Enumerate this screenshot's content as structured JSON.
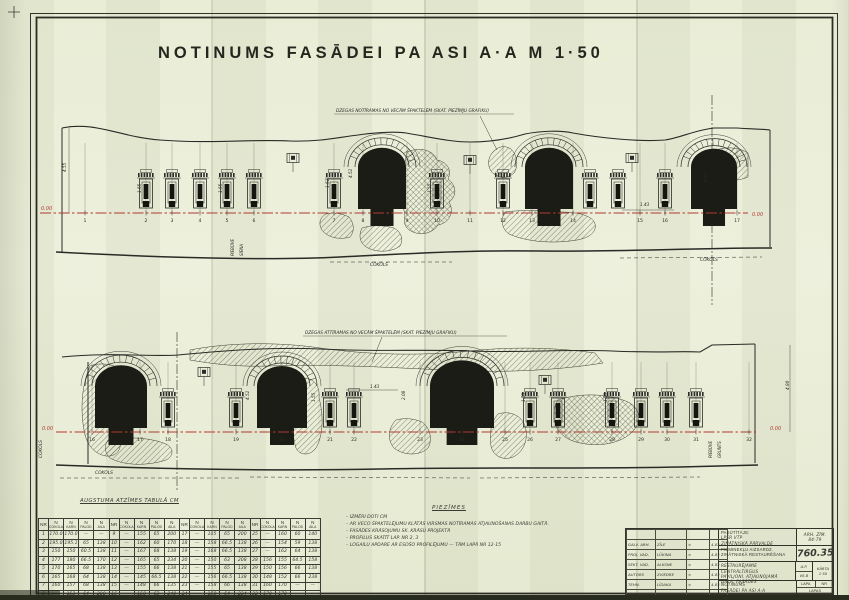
{
  "page": {
    "title": "NOTINUMS FASĀDEI PA ASI A·A M 1·50"
  },
  "colors": {
    "paper": "#eaeeda",
    "ink": "#2a2a26",
    "datum_red": "#b03a30"
  },
  "facade_top": {
    "annotation": "DZEGAS NOTĪRAMAS NO VECĀM ŠPAKTELĒM (SKAT. PIEZĪMJU GRAFIKU)",
    "datum_left": "0.00",
    "datum_right": "0.00",
    "axis_numbers": [
      "1",
      "2",
      "3",
      "4",
      "5",
      "6",
      "7",
      "8",
      "9",
      "10",
      "11",
      "12",
      "13",
      "14",
      "15",
      "16",
      "17"
    ],
    "dim_labels": [
      "4.55",
      "1.55",
      "1.55",
      "1.52",
      "4.52",
      "1.55",
      "1.43",
      "4.50"
    ],
    "cokols_label": "COKOLS",
    "side_labels": [
      "PIEBŪVE",
      "SIENA"
    ]
  },
  "facade_bottom": {
    "annotation": "DZEGAS ATTĪRAMAS NO VECĀM ŠPAKTELĒM (SKAT. PIEZĪMJU GRAFIKU)",
    "datum_left": "0.00",
    "datum_right": "0.00",
    "axis_numbers": [
      "16",
      "17",
      "18",
      "19",
      "20",
      "21",
      "22",
      "23",
      "24",
      "25",
      "26",
      "27",
      "28",
      "29",
      "30",
      "31",
      "32"
    ],
    "dim_labels": [
      "4.52",
      "1.55",
      "2.08",
      "1.55",
      "1.55",
      "1.43",
      "4.90"
    ],
    "cokols_label": "COKOLS",
    "side_labels": [
      "PIEBŪVE",
      "GRUNTS"
    ]
  },
  "table": {
    "caption": "AUGSTUMA ATZĪMES TABULĀ CM",
    "n_symbol": "N",
    "col_headers": [
      "NR",
      "COKOLA",
      "KARN",
      "PALOD",
      "AILA"
    ],
    "rows": [
      {
        "nr": "1",
        "c": "170.0",
        "k": "170.0",
        "p": "—",
        "a": "—"
      },
      {
        "nr": "2",
        "c": "195.0",
        "k": "195.1",
        "p": "65",
        "a": "138"
      },
      {
        "nr": "3",
        "c": "150",
        "k": "150",
        "p": "60.5",
        "a": "138"
      },
      {
        "nr": "4",
        "c": "177",
        "k": "180",
        "p": "66.5",
        "a": "170"
      },
      {
        "nr": "5",
        "c": "170",
        "k": "165",
        "p": "68",
        "a": "138"
      },
      {
        "nr": "6",
        "c": "165",
        "k": "168",
        "p": "64",
        "a": "138"
      },
      {
        "nr": "7",
        "c": "160",
        "k": "157",
        "p": "68",
        "a": "138"
      },
      {
        "nr": "8",
        "c": "—",
        "k": "153",
        "p": "64",
        "a": "200"
      },
      {
        "nr": "9",
        "c": "—",
        "k": "155",
        "p": "65",
        "a": "200"
      },
      {
        "nr": "10",
        "c": "—",
        "k": "162",
        "p": "60",
        "a": "170"
      },
      {
        "nr": "11",
        "c": "—",
        "k": "167",
        "p": "68",
        "a": "138"
      },
      {
        "nr": "12",
        "c": "—",
        "k": "165",
        "p": "65",
        "a": "234"
      },
      {
        "nr": "13",
        "c": "—",
        "k": "155",
        "p": "66",
        "a": "138"
      },
      {
        "nr": "14",
        "c": "—",
        "k": "145",
        "p": "66.5",
        "a": "138"
      },
      {
        "nr": "15",
        "c": "—",
        "k": "148",
        "p": "66",
        "a": "135"
      },
      {
        "nr": "16",
        "c": "—",
        "k": "150",
        "p": "63",
        "a": "240"
      },
      {
        "nr": "17",
        "c": "—",
        "k": "105",
        "p": "65",
        "a": "200"
      },
      {
        "nr": "18",
        "c": "—",
        "k": "158",
        "p": "66.5",
        "a": "138"
      },
      {
        "nr": "19",
        "c": "—",
        "k": "168",
        "p": "66.5",
        "a": "138"
      },
      {
        "nr": "20",
        "c": "—",
        "k": "150",
        "p": "63",
        "a": "208"
      },
      {
        "nr": "21",
        "c": "—",
        "k": "155",
        "p": "65",
        "a": "138"
      },
      {
        "nr": "22",
        "c": "—",
        "k": "156",
        "p": "66.5",
        "a": "138"
      },
      {
        "nr": "23",
        "c": "—",
        "k": "158",
        "p": "66",
        "a": "138"
      },
      {
        "nr": "24",
        "c": "—",
        "k": "158",
        "p": "64",
        "a": "234"
      },
      {
        "nr": "25",
        "c": "—",
        "k": "160",
        "p": "60",
        "a": "140"
      },
      {
        "nr": "26",
        "c": "—",
        "k": "154",
        "p": "59",
        "a": "138"
      },
      {
        "nr": "27",
        "c": "—",
        "k": "162",
        "p": "64",
        "a": "138"
      },
      {
        "nr": "28",
        "c": "156",
        "k": "155",
        "p": "64.5",
        "a": "158"
      },
      {
        "nr": "29",
        "c": "150",
        "k": "156",
        "p": "66",
        "a": "138"
      },
      {
        "nr": "30",
        "c": "148",
        "k": "152",
        "p": "66",
        "a": "238"
      },
      {
        "nr": "31",
        "c": "160",
        "k": "170",
        "p": "—",
        "a": "—"
      },
      {
        "nr": "32",
        "c": "170",
        "k": "170",
        "p": "—",
        "a": "—"
      }
    ]
  },
  "notes": {
    "header": "PIEZĪMES",
    "items": [
      "IZMĒRI DOTI CM",
      "AR VECO ŠPAKTELĒJUMU KLĀTĀS VIRSMAS NOTĪRAMAS ATJAUNOŠANAS DARBU GAITĀ.",
      "FASĀDES KRĀSOJUMU SK. KRĀSU PROJEKTĀ",
      "PROFILUS SKATĪT LAP. NR 2, 3",
      "LOGAILU APDARE AR ESOŠO PROFILĒJUMU — TĀM LAPĀ NR 12-15"
    ]
  },
  "titleblock": {
    "signatures": [
      {
        "role": "GALV. ARH.",
        "name": "ZĪLE",
        "sig": "≈",
        "date": "4.83"
      },
      {
        "role": "PROJ. VAD.",
        "name": "LŪKINA",
        "sig": "≈",
        "date": "4.83"
      },
      {
        "role": "SEKT. VAD.",
        "name": "ALKSNE",
        "sig": "≈",
        "date": "4.83"
      },
      {
        "role": "AUTORS",
        "name": "ZVIEDRE",
        "sig": "≈",
        "date": "4.83"
      },
      {
        "role": "TEHN.",
        "name": "LĪDAKA",
        "sig": "≈",
        "date": "4.83"
      }
    ],
    "client_label": "PASŪTĪTĀJS:",
    "client_line1": "LPSR VTP",
    "client_line2": "ZINĀTNISKĀ PĀRVALDE",
    "arch_no_label": "ARH. ZĪM.",
    "arch_no": "84-79",
    "org_line1": "PIEMINEKĻU AIZSARDZ.",
    "org_line2": "ZINĀTNISKĀ RESTAURĒŠANA",
    "project_no": "760.35",
    "object_line1": "RESTAURĒJAMIE CENTRĀLTIRGUS",
    "object_line2": "PAVILJONI. ATJAUNOJAMĀ",
    "object_line3": "DAĻA. FASĀDES",
    "stage_label": "A.P.",
    "stage_value": "VII-B",
    "karta_label": "KĀRTA",
    "karta_value": "1·50",
    "sheet_line1": "NOTINUMS",
    "sheet_line2": "FASĀDEI PA ASI A·A",
    "lapa_label": "LAPA",
    "nr_label": "NR",
    "lapas_label": "LAPAS"
  }
}
